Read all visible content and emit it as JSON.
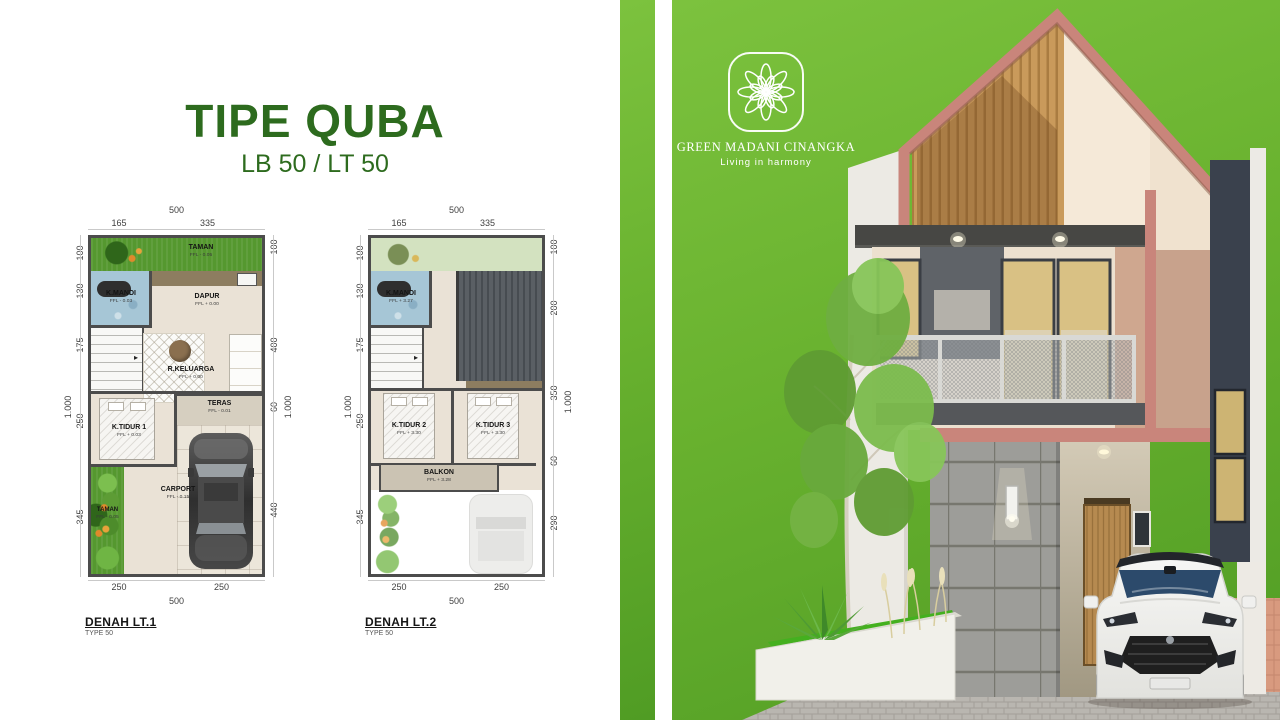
{
  "header": {
    "title": "TIPE QUBA",
    "subtitle": "LB 50 / LT 50"
  },
  "brand": {
    "name": "GREEN MADANI CINANGKA",
    "tagline": "Living in harmony",
    "logo_icon": "lotus-flower-icon"
  },
  "colors": {
    "title_green": "#2d6b1e",
    "panel_green": "#69b22f",
    "panel_green_dark": "#509c24",
    "roof_trim": "#c9857b",
    "wood_slats": "#c99a5b",
    "cream_wall": "#f3e6d4",
    "stone_wall": "#9c9c98",
    "driveway": "#d89a7f",
    "plan_grass": "#55982f",
    "bath_blue": "#a6c6d6"
  },
  "plans": [
    {
      "caption": "DENAH LT.1",
      "caption_sub": "TYPE 50",
      "rooms": {
        "taman_top": {
          "name": "TAMAN",
          "ffl": "FFL - 0.05"
        },
        "kmandi": {
          "name": "K.MANDI",
          "ffl": "FFL - 0.03"
        },
        "dapur": {
          "name": "DAPUR",
          "ffl": "FFL + 0.00"
        },
        "rkeluarga": {
          "name": "R.KELUARGA",
          "ffl": "FFL + 0.00"
        },
        "ktidur1": {
          "name": "K.TIDUR 1",
          "ffl": "FFL + 0.03"
        },
        "teras": {
          "name": "TERAS",
          "ffl": "FFL - 0.01"
        },
        "carport": {
          "name": "CARPORT",
          "ffl": "FFL - 0.15"
        },
        "taman_side": {
          "name": "TAMAN",
          "ffl": "FFL - 0.05"
        }
      },
      "dims": {
        "top_total": "500",
        "top_a": "165",
        "top_b": "335",
        "left_a": "100",
        "left_b": "130",
        "left_c": "175",
        "left_total": "1.000",
        "left_d": "250",
        "left_e": "345",
        "right_a": "100",
        "right_b": "400",
        "right_total": "1.000",
        "right_c": "60",
        "right_d": "440",
        "bottom_a": "250",
        "bottom_b": "250",
        "bottom_total": "500"
      }
    },
    {
      "caption": "DENAH LT.2",
      "caption_sub": "TYPE 50",
      "rooms": {
        "kmandi": {
          "name": "K.MANDI",
          "ffl": "FFL + 3.27"
        },
        "ktidur2": {
          "name": "K.TIDUR 2",
          "ffl": "FFL + 3.30"
        },
        "ktidur3": {
          "name": "K.TIDUR 3",
          "ffl": "FFL + 3.30"
        },
        "balkon": {
          "name": "BALKON",
          "ffl": "FFL + 3.28"
        }
      },
      "dims": {
        "top_total": "500",
        "top_a": "165",
        "top_b": "335",
        "left_a": "100",
        "left_b": "130",
        "left_c": "175",
        "left_total": "1.000",
        "left_d": "250",
        "left_e": "345",
        "right_a": "100",
        "right_b": "200",
        "right_c": "350",
        "right_total": "1.000",
        "right_d": "60",
        "right_e": "290",
        "bottom_a": "250",
        "bottom_b": "250",
        "bottom_total": "500"
      }
    }
  ]
}
